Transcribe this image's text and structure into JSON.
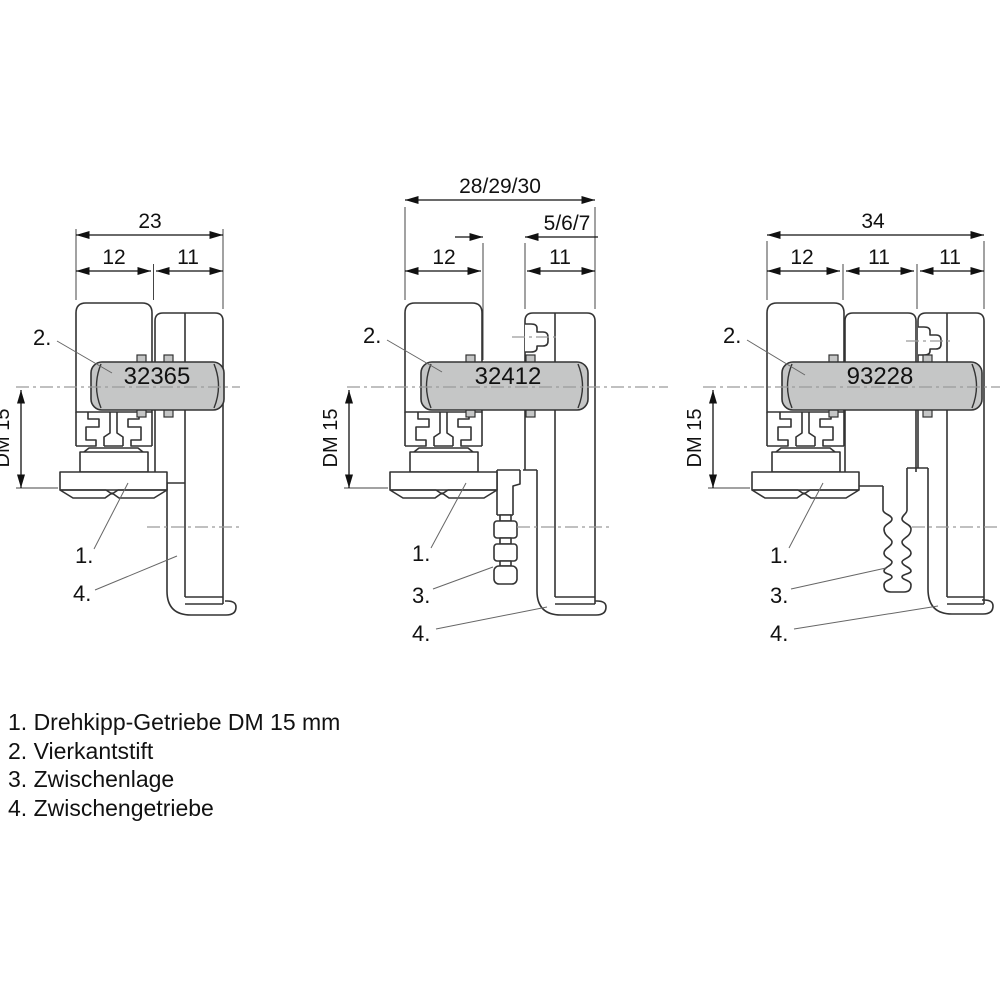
{
  "figures": [
    {
      "part_number": "32365",
      "dim_total": "23",
      "dim_left": "12",
      "dim_right": "11",
      "dm_label": "DM 15",
      "callout_spindle": "2.",
      "callout_gear": "1.",
      "callout_bracket": "4."
    },
    {
      "part_number": "32412",
      "dim_total": "28/29/30",
      "dim_gap": "5/6/7",
      "dim_left": "12",
      "dim_right": "11",
      "dm_label": "DM 15",
      "callout_spindle": "2.",
      "callout_gear": "1.",
      "callout_spacer": "3.",
      "callout_bracket": "4."
    },
    {
      "part_number": "93228",
      "dim_total": "34",
      "dim_left": "12",
      "dim_mid": "11",
      "dim_right": "11",
      "dm_label": "DM 15",
      "callout_spindle": "2.",
      "callout_gear": "1.",
      "callout_spacer": "3.",
      "callout_bracket": "4."
    }
  ],
  "legend": {
    "items": [
      "1. Drehkipp-Getriebe DM 15 mm",
      "2. Vierkantstift",
      "3. Zwischenlage",
      "4. Zwischengetriebe"
    ]
  },
  "colors": {
    "part_fill": "#c5c6c6",
    "line": "#333333",
    "centerline": "#9b9b9b",
    "background": "#ffffff"
  }
}
